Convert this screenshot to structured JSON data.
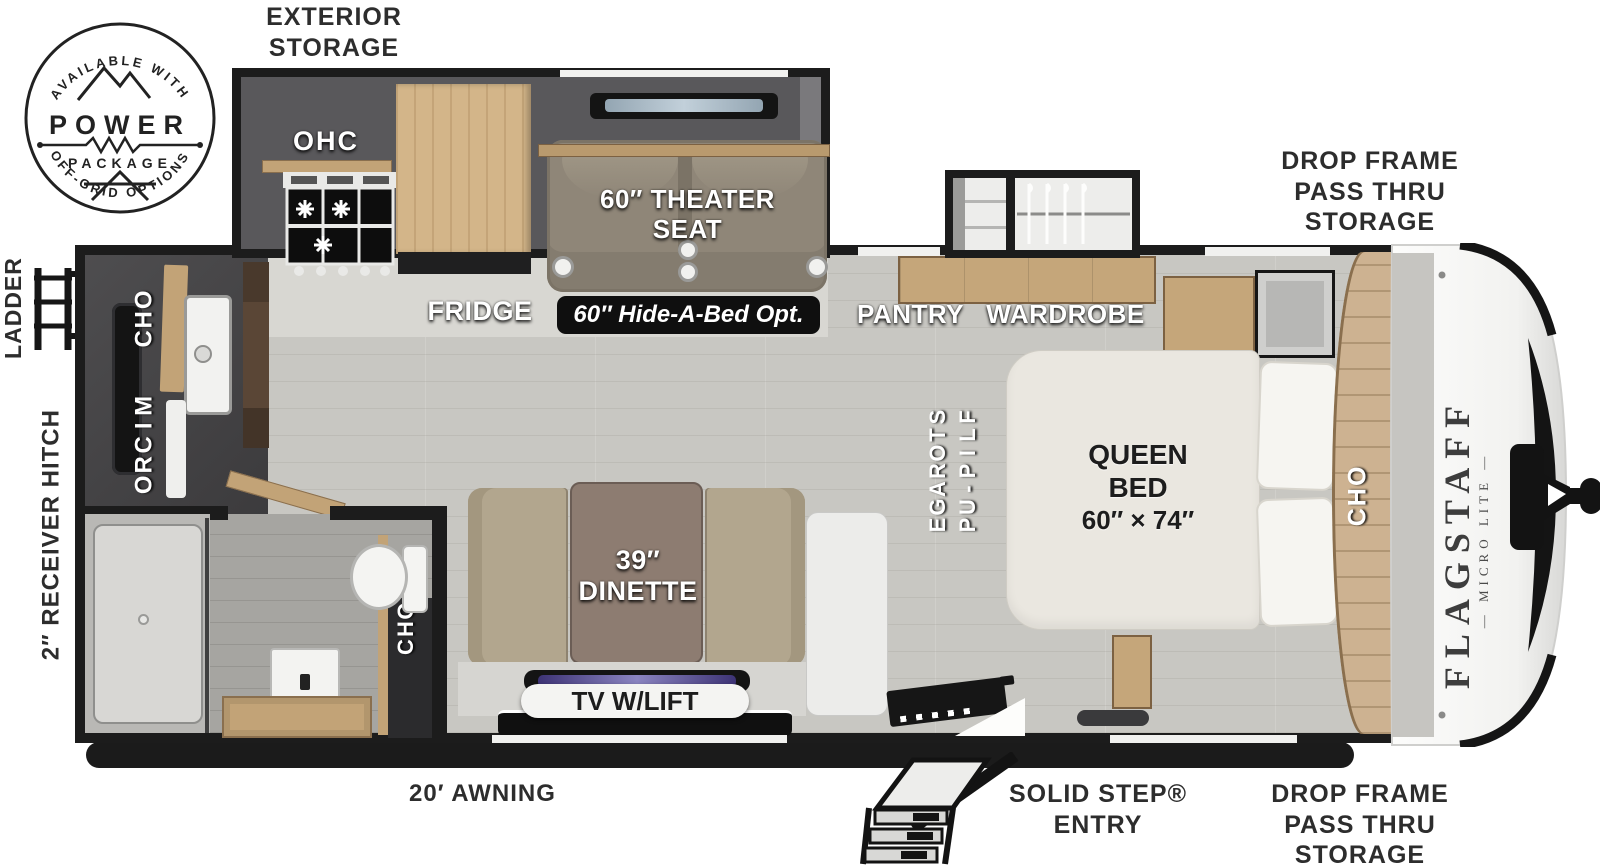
{
  "title": "Flagstaff Micro Lite travel trailer floor plan",
  "badge": {
    "arc_top": "AVAILABLE WITH",
    "power": "POWER",
    "package": "PACKAGE",
    "arc_bottom": "OFF-GRID OPTIONS"
  },
  "exterior_labels": {
    "exterior_storage_line1": "EXTERIOR",
    "exterior_storage_line2": "STORAGE",
    "drop_frame_line1": "DROP FRAME",
    "drop_frame_line2": "PASS THRU",
    "drop_frame_line3": "STORAGE",
    "ladder": "LADDER",
    "receiver_hitch": "2″ RECEIVER HITCH",
    "awning": "20′ AWNING",
    "solid_step_line1": "SOLID STEP®",
    "solid_step_line2": "ENTRY"
  },
  "interior_labels": {
    "ohc": "OHC",
    "micro": "MICRO",
    "fridge": "FRIDGE",
    "theater_line1": "60″ THEATER",
    "theater_line2": "SEAT",
    "hide_a_bed": "60″ Hide-A-Bed Opt.",
    "pantry": "PANTRY",
    "wardrobe": "WARDROBE",
    "flip_up_word1": "FLIP-UP",
    "flip_up_word2": "STORAGE",
    "queen_line1": "QUEEN",
    "queen_line2": "BED",
    "queen_line3": "60″ × 74″",
    "dinette_line1": "39″",
    "dinette_line2": "DINETTE",
    "tv_lift": "TV W/LIFT"
  },
  "brand": {
    "name": "FLAGSTAFF",
    "model": "— MICRO LITE —"
  },
  "colors": {
    "wall": "#1c1c1c",
    "floor": "#c8c7c2",
    "wood": "#c5a67a",
    "wood_light": "#d3b589",
    "theater_seat": "#8f8678",
    "bench": "#b2a68e",
    "table": "#8d7c71",
    "bed": "#eae7e0",
    "label_white": "#ffffff",
    "label_dark": "#2d2d2d",
    "badge_bg": "#0f0f0f",
    "tv_screen_accent": "#5a51a0"
  }
}
